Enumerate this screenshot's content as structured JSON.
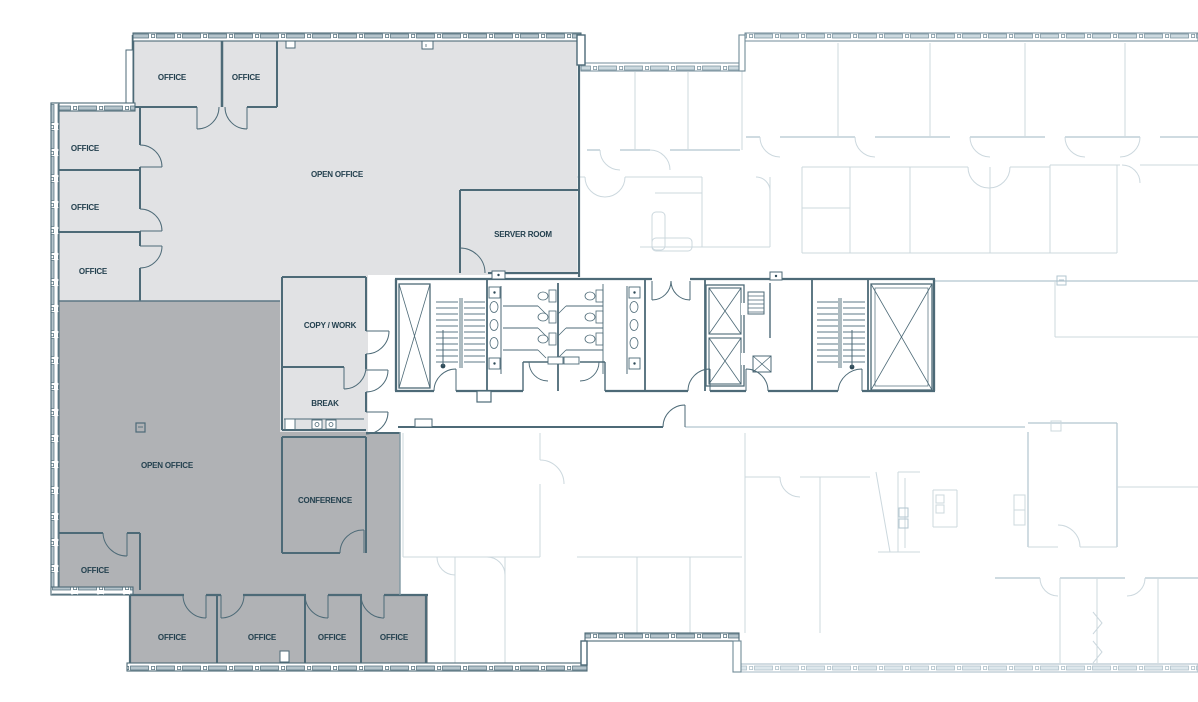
{
  "document": {
    "type": "office floor plan drawing"
  },
  "colors": {
    "background": "#ffffff",
    "suite_upper_fill": "#e1e2e4",
    "suite_lower_fill": "#b0b2b5",
    "wall": "#4d6a77",
    "wall_medium": "#718b98",
    "label_text": "#24414f",
    "faint_line": "#ccd8de",
    "faint_line_strong": "#b2c5cf"
  },
  "zones": [
    {
      "id": "upper-suite",
      "shade": "light-gray"
    },
    {
      "id": "lower-suite",
      "shade": "medium-gray"
    }
  ],
  "features": [
    "stairwell-west",
    "restrooms",
    "elevator-bank",
    "stairwell-east",
    "shafts"
  ],
  "rooms": [
    {
      "id": "office-top-1",
      "zone": "upper-suite",
      "label": "OFFICE"
    },
    {
      "id": "office-top-2",
      "zone": "upper-suite",
      "label": "OFFICE"
    },
    {
      "id": "office-west-1",
      "zone": "upper-suite",
      "label": "OFFICE"
    },
    {
      "id": "office-west-2",
      "zone": "upper-suite",
      "label": "OFFICE"
    },
    {
      "id": "office-west-3",
      "zone": "upper-suite",
      "label": "OFFICE"
    },
    {
      "id": "open-office-upper",
      "zone": "upper-suite",
      "label": "OPEN OFFICE"
    },
    {
      "id": "server-room",
      "zone": "upper-suite",
      "label": "SERVER ROOM"
    },
    {
      "id": "copy-work-room",
      "zone": "upper-suite",
      "label": "COPY / WORK"
    },
    {
      "id": "break-room",
      "zone": "upper-suite",
      "label": "BREAK"
    },
    {
      "id": "open-office-lower",
      "zone": "lower-suite",
      "label": "OPEN OFFICE"
    },
    {
      "id": "conference-room",
      "zone": "lower-suite",
      "label": "CONFERENCE"
    },
    {
      "id": "office-southwest",
      "zone": "lower-suite",
      "label": "OFFICE"
    },
    {
      "id": "office-south-1",
      "zone": "lower-suite",
      "label": "OFFICE"
    },
    {
      "id": "office-south-2",
      "zone": "lower-suite",
      "label": "OFFICE"
    },
    {
      "id": "office-south-3",
      "zone": "lower-suite",
      "label": "OFFICE"
    },
    {
      "id": "office-south-4",
      "zone": "lower-suite",
      "label": "OFFICE"
    }
  ]
}
